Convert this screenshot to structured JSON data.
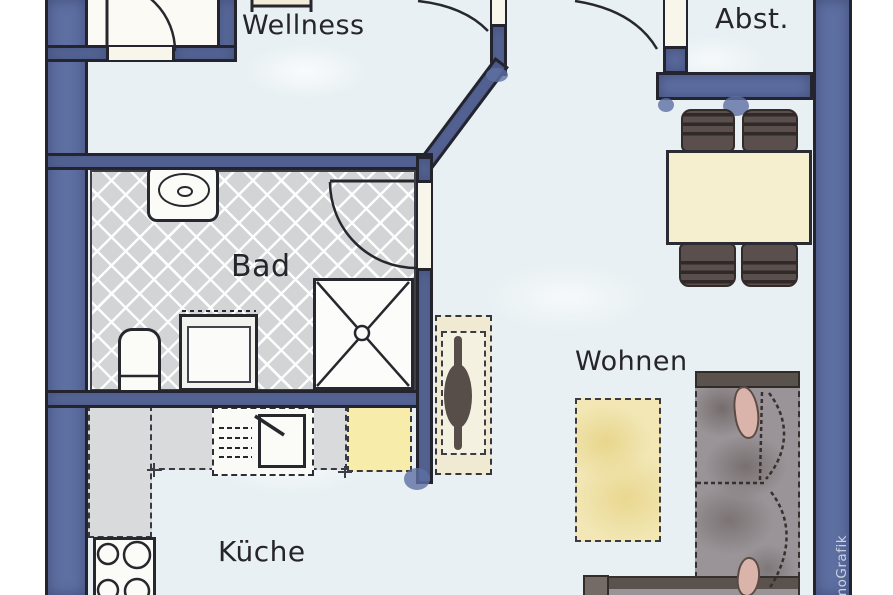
{
  "plan": {
    "kind": "apartment floor plan, hand-drawn watercolor style",
    "labels": {
      "wellness": "Wellness",
      "abstellraum": "Abst.",
      "bad": "Bad",
      "wohnen": "Wohnen",
      "kueche": "Küche"
    },
    "watermark": "moGrafik",
    "furniture": {
      "bad": [
        "washbasin",
        "toilet",
        "washing-machine",
        "shower"
      ],
      "kueche": [
        "l-shaped-counter",
        "sink-with-drainboard",
        "stove-4-burners",
        "fridge-cabinet"
      ],
      "wohnen": [
        "rug",
        "corner-sofa",
        "console-sideboard"
      ],
      "dining": [
        "dining-table",
        "chair",
        "chair",
        "chair",
        "chair"
      ]
    },
    "colors": {
      "wall": "#5e6fa2",
      "outline": "#27282e",
      "floor": "#e8f0f3",
      "tile": "#d2d4d6",
      "counter": "#d8dadb",
      "table_cream": "#f6efcf",
      "cabinet_yellow": "#f8ecab",
      "rug_yellow": "#f2e7b5",
      "chair_brown": "#5a4f4c",
      "sofa_gray": "#9a9498",
      "pillow_pink": "#dab3aa"
    }
  }
}
